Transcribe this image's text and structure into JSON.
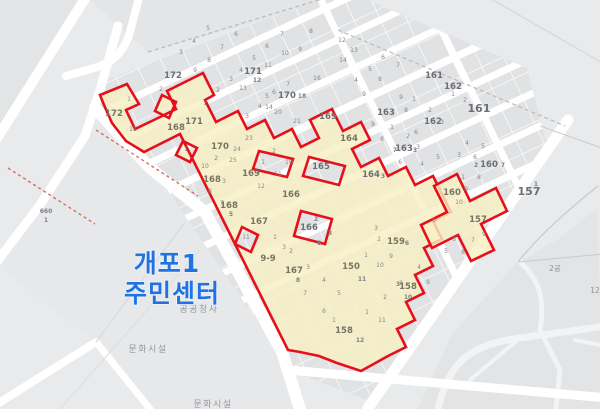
{
  "map": {
    "landmark": {
      "line1": "개포1",
      "line2": "주민센터",
      "color": "#2273e2"
    },
    "facility_labels": [
      {
        "text": "공공청사"
      },
      {
        "text": "문화시설"
      },
      {
        "text": "문화시설"
      }
    ],
    "colors": {
      "background": "#e9eaeb",
      "parcel_gray": "#e1e2e3",
      "road_white": "#ffffff",
      "highlight_yellow": "#f6f0c3",
      "boundary_red": "#e60f1a",
      "landmark_blue": "#2273e2",
      "label_gray": "#85878c"
    },
    "labels": [
      {
        "t": "172",
        "x": 173,
        "y": 78,
        "c": "b"
      },
      {
        "t": "171",
        "x": 253,
        "y": 74,
        "c": "b"
      },
      {
        "t": "12",
        "x": 257,
        "y": 82,
        "c": "s"
      },
      {
        "t": "170",
        "x": 287,
        "y": 98,
        "c": "b"
      },
      {
        "t": "18",
        "x": 302,
        "y": 98,
        "c": "s"
      },
      {
        "t": "169",
        "x": 328,
        "y": 119,
        "c": "b"
      },
      {
        "t": "163",
        "x": 386,
        "y": 115,
        "c": "b"
      },
      {
        "t": "7",
        "x": 395,
        "y": 152,
        "c": "s"
      },
      {
        "t": "163",
        "x": 404,
        "y": 151,
        "c": "b"
      },
      {
        "t": "3",
        "x": 415,
        "y": 152,
        "c": "s"
      },
      {
        "t": "162",
        "x": 453,
        "y": 89,
        "c": "b"
      },
      {
        "t": "162",
        "x": 433,
        "y": 124,
        "c": "b"
      },
      {
        "t": "161",
        "x": 434,
        "y": 78,
        "c": "b"
      },
      {
        "t": "161",
        "x": 479,
        "y": 112,
        "c": "b big"
      },
      {
        "t": "2",
        "x": 476,
        "y": 167,
        "c": "s"
      },
      {
        "t": "160",
        "x": 489,
        "y": 167,
        "c": "b"
      },
      {
        "t": "7",
        "x": 503,
        "y": 167,
        "c": "s"
      },
      {
        "t": "165",
        "x": 321,
        "y": 169,
        "c": "b"
      },
      {
        "t": "164",
        "x": 371,
        "y": 177,
        "c": "b"
      },
      {
        "t": "3",
        "x": 383,
        "y": 178,
        "c": "s"
      },
      {
        "t": "166",
        "x": 309,
        "y": 230,
        "c": "b"
      },
      {
        "t": "2",
        "x": 316,
        "y": 221,
        "c": "s"
      },
      {
        "t": "3",
        "x": 330,
        "y": 235,
        "c": "s"
      },
      {
        "t": "6",
        "x": 319,
        "y": 245,
        "c": "s"
      },
      {
        "t": "157",
        "x": 529,
        "y": 195,
        "c": "b big"
      },
      {
        "t": "1",
        "x": 536,
        "y": 186,
        "c": "s"
      },
      {
        "t": "660",
        "x": 46,
        "y": 213,
        "c": "s"
      },
      {
        "t": "1",
        "x": 46,
        "y": 222,
        "c": "s"
      },
      {
        "t": "2공",
        "x": 555,
        "y": 271,
        "c": "fsm"
      },
      {
        "t": "12",
        "x": 595,
        "y": 293,
        "c": "fsm"
      },
      {
        "t": "172",
        "x": 114,
        "y": 116,
        "c": "y"
      },
      {
        "t": "171",
        "x": 194,
        "y": 124,
        "c": "y"
      },
      {
        "t": "170",
        "x": 220,
        "y": 149,
        "c": "y"
      },
      {
        "t": "169",
        "x": 251,
        "y": 176,
        "c": "y"
      },
      {
        "t": "168",
        "x": 176,
        "y": 130,
        "c": "y"
      },
      {
        "t": "168",
        "x": 212,
        "y": 182,
        "c": "y"
      },
      {
        "t": "168",
        "x": 229,
        "y": 208,
        "c": "y"
      },
      {
        "t": "5",
        "x": 231,
        "y": 216,
        "c": "s"
      },
      {
        "t": "167",
        "x": 259,
        "y": 224,
        "c": "y"
      },
      {
        "t": "167",
        "x": 294,
        "y": 273,
        "c": "y"
      },
      {
        "t": "8",
        "x": 298,
        "y": 282,
        "c": "s"
      },
      {
        "t": "166",
        "x": 291,
        "y": 197,
        "c": "y"
      },
      {
        "t": "164",
        "x": 349,
        "y": 141,
        "c": "y"
      },
      {
        "t": "159",
        "x": 396,
        "y": 244,
        "c": "y"
      },
      {
        "t": "6",
        "x": 407,
        "y": 245,
        "c": "s"
      },
      {
        "t": "158",
        "x": 408,
        "y": 289,
        "c": "y"
      },
      {
        "t": "158",
        "x": 344,
        "y": 333,
        "c": "y"
      },
      {
        "t": "150",
        "x": 351,
        "y": 269,
        "c": "y"
      },
      {
        "t": "157",
        "x": 478,
        "y": 222,
        "c": "y"
      },
      {
        "t": "160",
        "x": 452,
        "y": 195,
        "c": "y"
      },
      {
        "t": "9-9",
        "x": 268,
        "y": 261,
        "c": "y"
      },
      {
        "t": "10",
        "x": 408,
        "y": 299,
        "c": "s"
      },
      {
        "t": "12",
        "x": 360,
        "y": 342,
        "c": "s"
      },
      {
        "t": "11",
        "x": 362,
        "y": 281,
        "c": "s"
      },
      {
        "t": "3",
        "x": 398,
        "y": 286,
        "c": "s"
      },
      {
        "t": "5",
        "x": 208,
        "y": 30,
        "c": "n"
      },
      {
        "t": "6",
        "x": 236,
        "y": 36,
        "c": "n"
      },
      {
        "t": "4",
        "x": 194,
        "y": 43,
        "c": "n"
      },
      {
        "t": "7",
        "x": 222,
        "y": 49,
        "c": "n"
      },
      {
        "t": "3",
        "x": 181,
        "y": 54,
        "c": "n"
      },
      {
        "t": "8",
        "x": 209,
        "y": 62,
        "c": "n"
      },
      {
        "t": "9",
        "x": 195,
        "y": 72,
        "c": "n"
      },
      {
        "t": "2",
        "x": 161,
        "y": 91,
        "c": "n"
      },
      {
        "t": "7",
        "x": 282,
        "y": 36,
        "c": "n"
      },
      {
        "t": "8",
        "x": 311,
        "y": 33,
        "c": "n"
      },
      {
        "t": "9",
        "x": 300,
        "y": 51,
        "c": "n"
      },
      {
        "t": "6",
        "x": 267,
        "y": 48,
        "c": "n"
      },
      {
        "t": "5",
        "x": 254,
        "y": 60,
        "c": "n"
      },
      {
        "t": "10",
        "x": 285,
        "y": 55,
        "c": "n"
      },
      {
        "t": "11",
        "x": 268,
        "y": 67,
        "c": "n"
      },
      {
        "t": "4",
        "x": 241,
        "y": 72,
        "c": "n"
      },
      {
        "t": "3",
        "x": 231,
        "y": 81,
        "c": "n"
      },
      {
        "t": "13",
        "x": 243,
        "y": 90,
        "c": "n"
      },
      {
        "t": "2",
        "x": 218,
        "y": 92,
        "c": "n"
      },
      {
        "t": "14",
        "x": 269,
        "y": 109,
        "c": "n"
      },
      {
        "t": "1",
        "x": 205,
        "y": 105,
        "c": "n"
      },
      {
        "t": "16",
        "x": 317,
        "y": 80,
        "c": "n"
      },
      {
        "t": "7",
        "x": 288,
        "y": 86,
        "c": "n"
      },
      {
        "t": "6",
        "x": 274,
        "y": 94,
        "c": "n"
      },
      {
        "t": "5",
        "x": 267,
        "y": 98,
        "c": "n"
      },
      {
        "t": "4",
        "x": 260,
        "y": 108,
        "c": "n"
      },
      {
        "t": "20",
        "x": 278,
        "y": 114,
        "c": "n"
      },
      {
        "t": "21",
        "x": 297,
        "y": 123,
        "c": "n"
      },
      {
        "t": "3",
        "x": 247,
        "y": 118,
        "c": "n"
      },
      {
        "t": "23",
        "x": 249,
        "y": 140,
        "c": "n"
      },
      {
        "t": "24",
        "x": 237,
        "y": 151,
        "c": "n"
      },
      {
        "t": "2",
        "x": 274,
        "y": 153,
        "c": "n"
      },
      {
        "t": "1",
        "x": 263,
        "y": 164,
        "c": "n"
      },
      {
        "t": "10",
        "x": 289,
        "y": 164,
        "c": "n"
      },
      {
        "t": "11",
        "x": 278,
        "y": 176,
        "c": "n"
      },
      {
        "t": "12",
        "x": 261,
        "y": 188,
        "c": "n"
      },
      {
        "t": "9",
        "x": 373,
        "y": 126,
        "c": "n"
      },
      {
        "t": "1",
        "x": 392,
        "y": 129,
        "c": "n"
      },
      {
        "t": "8",
        "x": 382,
        "y": 141,
        "c": "n"
      },
      {
        "t": "2",
        "x": 408,
        "y": 138,
        "c": "n"
      },
      {
        "t": "3",
        "x": 418,
        "y": 149,
        "c": "n"
      },
      {
        "t": "6",
        "x": 400,
        "y": 164,
        "c": "n"
      },
      {
        "t": "4",
        "x": 422,
        "y": 166,
        "c": "n"
      },
      {
        "t": "5",
        "x": 438,
        "y": 159,
        "c": "n"
      },
      {
        "t": "12",
        "x": 342,
        "y": 42,
        "c": "n"
      },
      {
        "t": "13",
        "x": 354,
        "y": 52,
        "c": "n"
      },
      {
        "t": "14",
        "x": 343,
        "y": 62,
        "c": "n"
      },
      {
        "t": "6",
        "x": 383,
        "y": 59,
        "c": "n"
      },
      {
        "t": "7",
        "x": 398,
        "y": 67,
        "c": "n"
      },
      {
        "t": "5",
        "x": 370,
        "y": 71,
        "c": "n"
      },
      {
        "t": "4",
        "x": 356,
        "y": 82,
        "c": "n"
      },
      {
        "t": "8",
        "x": 380,
        "y": 81,
        "c": "n"
      },
      {
        "t": "9",
        "x": 364,
        "y": 96,
        "c": "n"
      },
      {
        "t": "1",
        "x": 453,
        "y": 96,
        "c": "n"
      },
      {
        "t": "2",
        "x": 465,
        "y": 102,
        "c": "n"
      },
      {
        "t": "9",
        "x": 401,
        "y": 99,
        "c": "n"
      },
      {
        "t": "1",
        "x": 414,
        "y": 101,
        "c": "n"
      },
      {
        "t": "8",
        "x": 406,
        "y": 112,
        "c": "n"
      },
      {
        "t": "2",
        "x": 430,
        "y": 112,
        "c": "n"
      },
      {
        "t": "3",
        "x": 442,
        "y": 124,
        "c": "n"
      },
      {
        "t": "6",
        "x": 416,
        "y": 134,
        "c": "n"
      },
      {
        "t": "4",
        "x": 467,
        "y": 145,
        "c": "n"
      },
      {
        "t": "5",
        "x": 483,
        "y": 148,
        "c": "n"
      },
      {
        "t": "3",
        "x": 459,
        "y": 157,
        "c": "n"
      },
      {
        "t": "6",
        "x": 475,
        "y": 159,
        "c": "n"
      },
      {
        "t": "1",
        "x": 463,
        "y": 179,
        "c": "n"
      },
      {
        "t": "8",
        "x": 479,
        "y": 179,
        "c": "n"
      },
      {
        "t": "9",
        "x": 466,
        "y": 191,
        "c": "n"
      },
      {
        "t": "10",
        "x": 459,
        "y": 204,
        "c": "n"
      },
      {
        "t": "9",
        "x": 484,
        "y": 236,
        "c": "n"
      },
      {
        "t": "6",
        "x": 434,
        "y": 222,
        "c": "n"
      },
      {
        "t": "6",
        "x": 454,
        "y": 241,
        "c": "n"
      },
      {
        "t": "5",
        "x": 446,
        "y": 253,
        "c": "n"
      },
      {
        "t": "7",
        "x": 473,
        "y": 242,
        "c": "n"
      },
      {
        "t": "8",
        "x": 463,
        "y": 254,
        "c": "n"
      },
      {
        "t": "3",
        "x": 376,
        "y": 230,
        "c": "n"
      },
      {
        "t": "9",
        "x": 391,
        "y": 258,
        "c": "n"
      },
      {
        "t": "2",
        "x": 379,
        "y": 241,
        "c": "n"
      },
      {
        "t": "4",
        "x": 419,
        "y": 269,
        "c": "n"
      },
      {
        "t": "9",
        "x": 428,
        "y": 284,
        "c": "n"
      },
      {
        "t": "10",
        "x": 380,
        "y": 267,
        "c": "n"
      },
      {
        "t": "4",
        "x": 324,
        "y": 282,
        "c": "n"
      },
      {
        "t": "5",
        "x": 339,
        "y": 295,
        "c": "n"
      },
      {
        "t": "3",
        "x": 308,
        "y": 269,
        "c": "n"
      },
      {
        "t": "7",
        "x": 305,
        "y": 295,
        "c": "n"
      },
      {
        "t": "6",
        "x": 324,
        "y": 313,
        "c": "n"
      },
      {
        "t": "1",
        "x": 367,
        "y": 314,
        "c": "n"
      },
      {
        "t": "11",
        "x": 382,
        "y": 322,
        "c": "n"
      },
      {
        "t": "1",
        "x": 334,
        "y": 322,
        "c": "n"
      },
      {
        "t": "2",
        "x": 385,
        "y": 299,
        "c": "n"
      },
      {
        "t": "3",
        "x": 401,
        "y": 285,
        "c": "n"
      },
      {
        "t": "1",
        "x": 275,
        "y": 239,
        "c": "n"
      },
      {
        "t": "3",
        "x": 284,
        "y": 249,
        "c": "n"
      },
      {
        "t": "2",
        "x": 291,
        "y": 253,
        "c": "n"
      },
      {
        "t": "1",
        "x": 366,
        "y": 257,
        "c": "n"
      },
      {
        "t": "1",
        "x": 129,
        "y": 101,
        "c": "n"
      },
      {
        "t": "11",
        "x": 133,
        "y": 131,
        "c": "n"
      },
      {
        "t": "10",
        "x": 205,
        "y": 168,
        "c": "n"
      },
      {
        "t": "2",
        "x": 216,
        "y": 160,
        "c": "n"
      },
      {
        "t": "3",
        "x": 224,
        "y": 183,
        "c": "n"
      },
      {
        "t": "8",
        "x": 210,
        "y": 193,
        "c": "n"
      },
      {
        "t": "7",
        "x": 222,
        "y": 205,
        "c": "n"
      },
      {
        "t": "25",
        "x": 233,
        "y": 162,
        "c": "n"
      },
      {
        "t": "1",
        "x": 186,
        "y": 151,
        "c": "n"
      },
      {
        "t": "11",
        "x": 246,
        "y": 239,
        "c": "n"
      }
    ]
  }
}
